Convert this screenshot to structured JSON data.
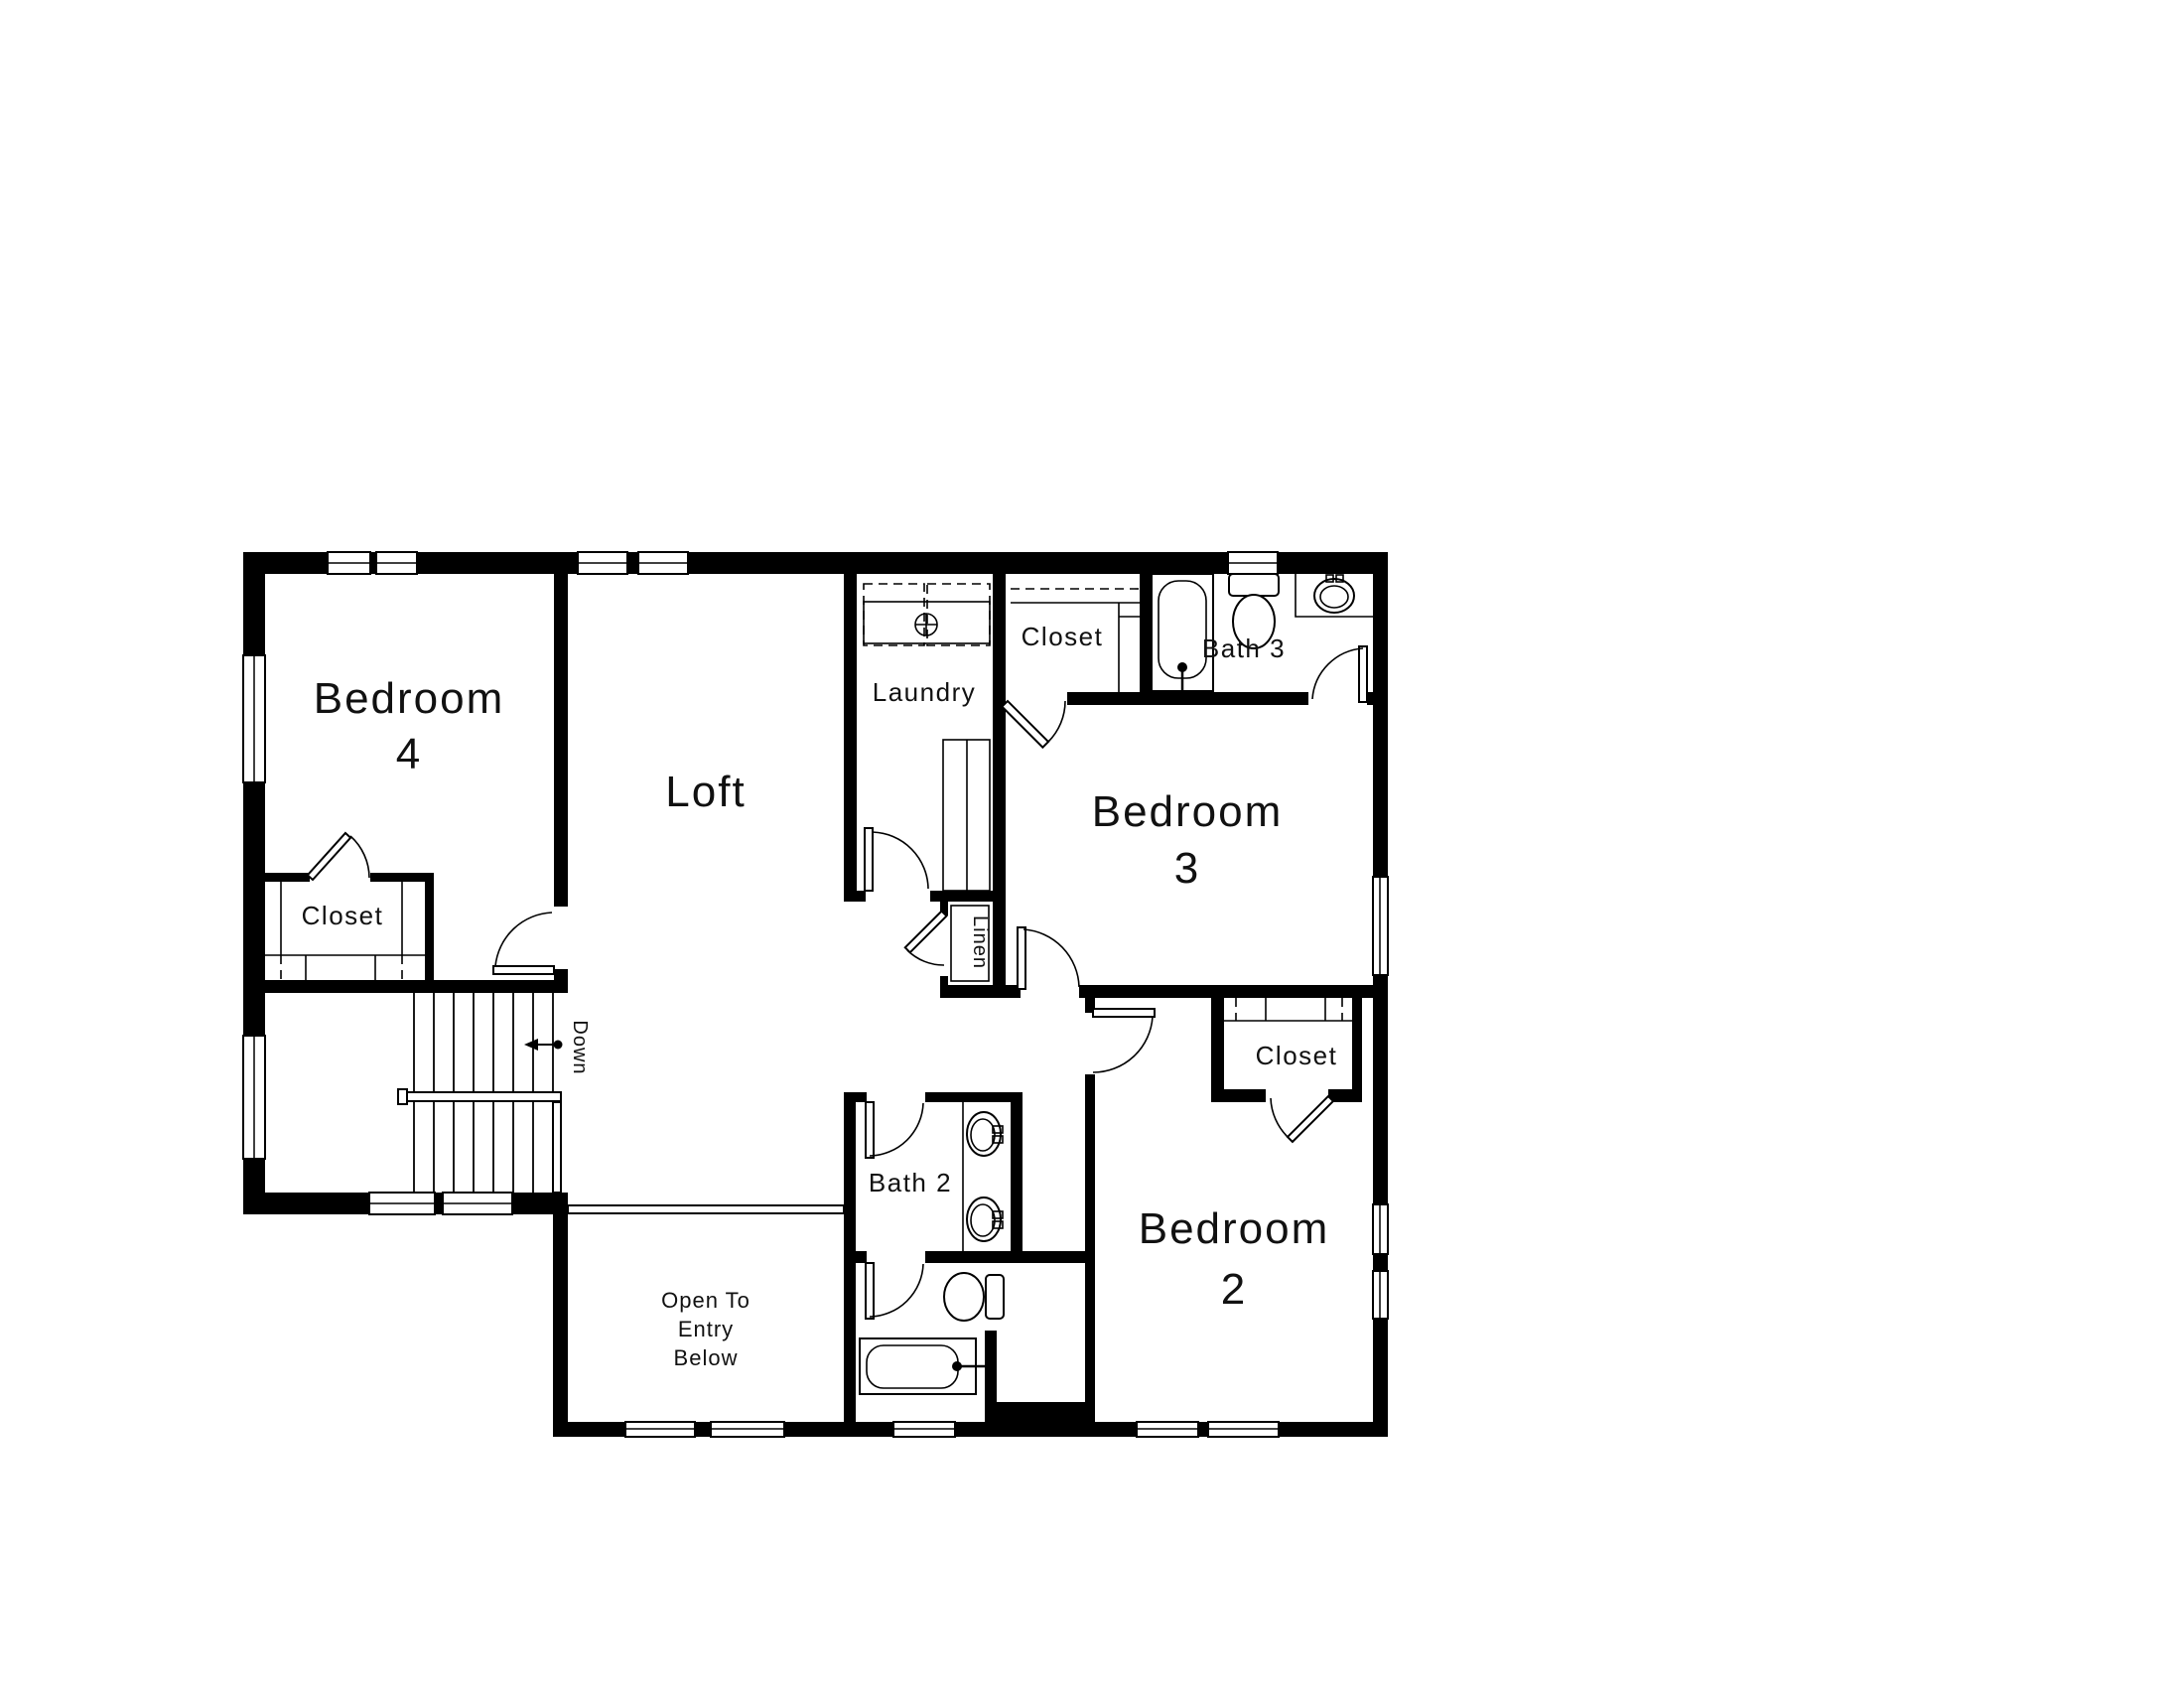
{
  "plan": {
    "type": "second-floor residential floor plan",
    "colors": {
      "walls": "#000000",
      "background": "#ffffff",
      "lines": "#111111"
    }
  },
  "rooms": {
    "bedroom4": {
      "name": "Bedroom",
      "number": "4"
    },
    "bedroom3": {
      "name": "Bedroom",
      "number": "3"
    },
    "bedroom2": {
      "name": "Bedroom",
      "number": "2"
    },
    "loft": {
      "label": "Loft"
    },
    "laundry": {
      "label": "Laundry"
    },
    "bath3": {
      "label": "Bath 3"
    },
    "bath2": {
      "label": "Bath 2"
    },
    "linen": {
      "label": "Linen"
    },
    "closet_bedroom4": {
      "label": "Closet"
    },
    "closet_bedroom3": {
      "label": "Closet"
    },
    "closet_bedroom2": {
      "label": "Closet"
    },
    "stairs": {
      "direction_label": "Down"
    },
    "open_to_entry": {
      "line1": "Open To",
      "line2": "Entry",
      "line3": "Below"
    }
  },
  "fixtures": {
    "bath3": [
      "bathtub",
      "toilet",
      "sink"
    ],
    "bath2": [
      "sink",
      "sink",
      "toilet",
      "bathtub"
    ],
    "laundry": [
      "washer-dryer",
      "counter"
    ],
    "stairwell": [
      "stairs",
      "handrail",
      "down-arrow"
    ]
  }
}
